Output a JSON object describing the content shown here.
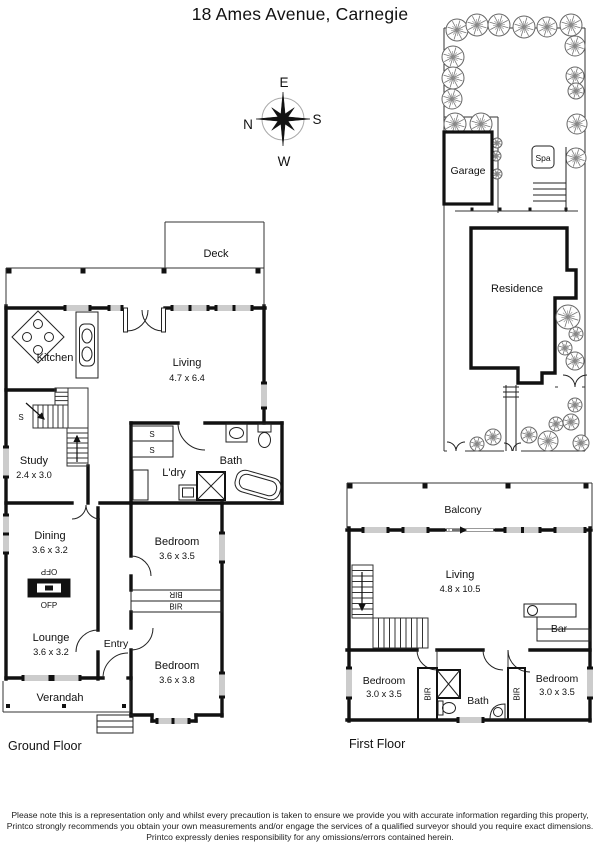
{
  "title": "18 Ames Avenue, Carnegie",
  "compass": {
    "north": "N",
    "east": "E",
    "south": "S",
    "west": "W"
  },
  "site": {
    "garage": "Garage",
    "spa": "Spa",
    "residence": "Residence"
  },
  "ground": {
    "floor_label": "Ground Floor",
    "deck": "Deck",
    "kitchen": "Kitchen",
    "living": {
      "name": "Living",
      "dims": "4.7 x 6.4"
    },
    "study": {
      "name": "Study",
      "dims": "2.4 x 3.0"
    },
    "laundry": "L'dry",
    "bath": "Bath",
    "dining": {
      "name": "Dining",
      "dims": "3.6 x 3.2"
    },
    "bedroom1": {
      "name": "Bedroom",
      "dims": "3.6 x 3.5"
    },
    "lounge": {
      "name": "Lounge",
      "dims": "3.6 x 3.2"
    },
    "entry": "Entry",
    "bedroom2": {
      "name": "Bedroom",
      "dims": "3.6 x 3.8"
    },
    "verandah": "Verandah",
    "stair_marker": "S",
    "cupboard_marker": "S",
    "robe_marker": "BIR",
    "fireplace_marker": "OFP"
  },
  "first": {
    "floor_label": "First Floor",
    "balcony": "Balcony",
    "living": {
      "name": "Living",
      "dims": "4.8 x 10.5"
    },
    "bar": "Bar",
    "bedroom_left": {
      "name": "Bedroom",
      "dims": "3.0 x 3.5"
    },
    "bedroom_right": {
      "name": "Bedroom",
      "dims": "3.0 x 3.5"
    },
    "bath": "Bath",
    "robe_marker": "BIR"
  },
  "icons": {
    "compass": "compass-rose",
    "tree": "tree-symbol",
    "stairs": "stair-treads",
    "fireplace": "open-fireplace-symbol"
  },
  "disclaimer": {
    "line1": "Please note this is a representation only and whilst every precaution is taken to ensure we provide you with accurate information regarding this property,",
    "line2": "Printco strongly recommends you obtain your own measurements and/or engage the services of a qualified surveyor should you require exact dimensions.",
    "line3": "Printco expressly denies responsibility for any omissions/errors contained herein."
  }
}
